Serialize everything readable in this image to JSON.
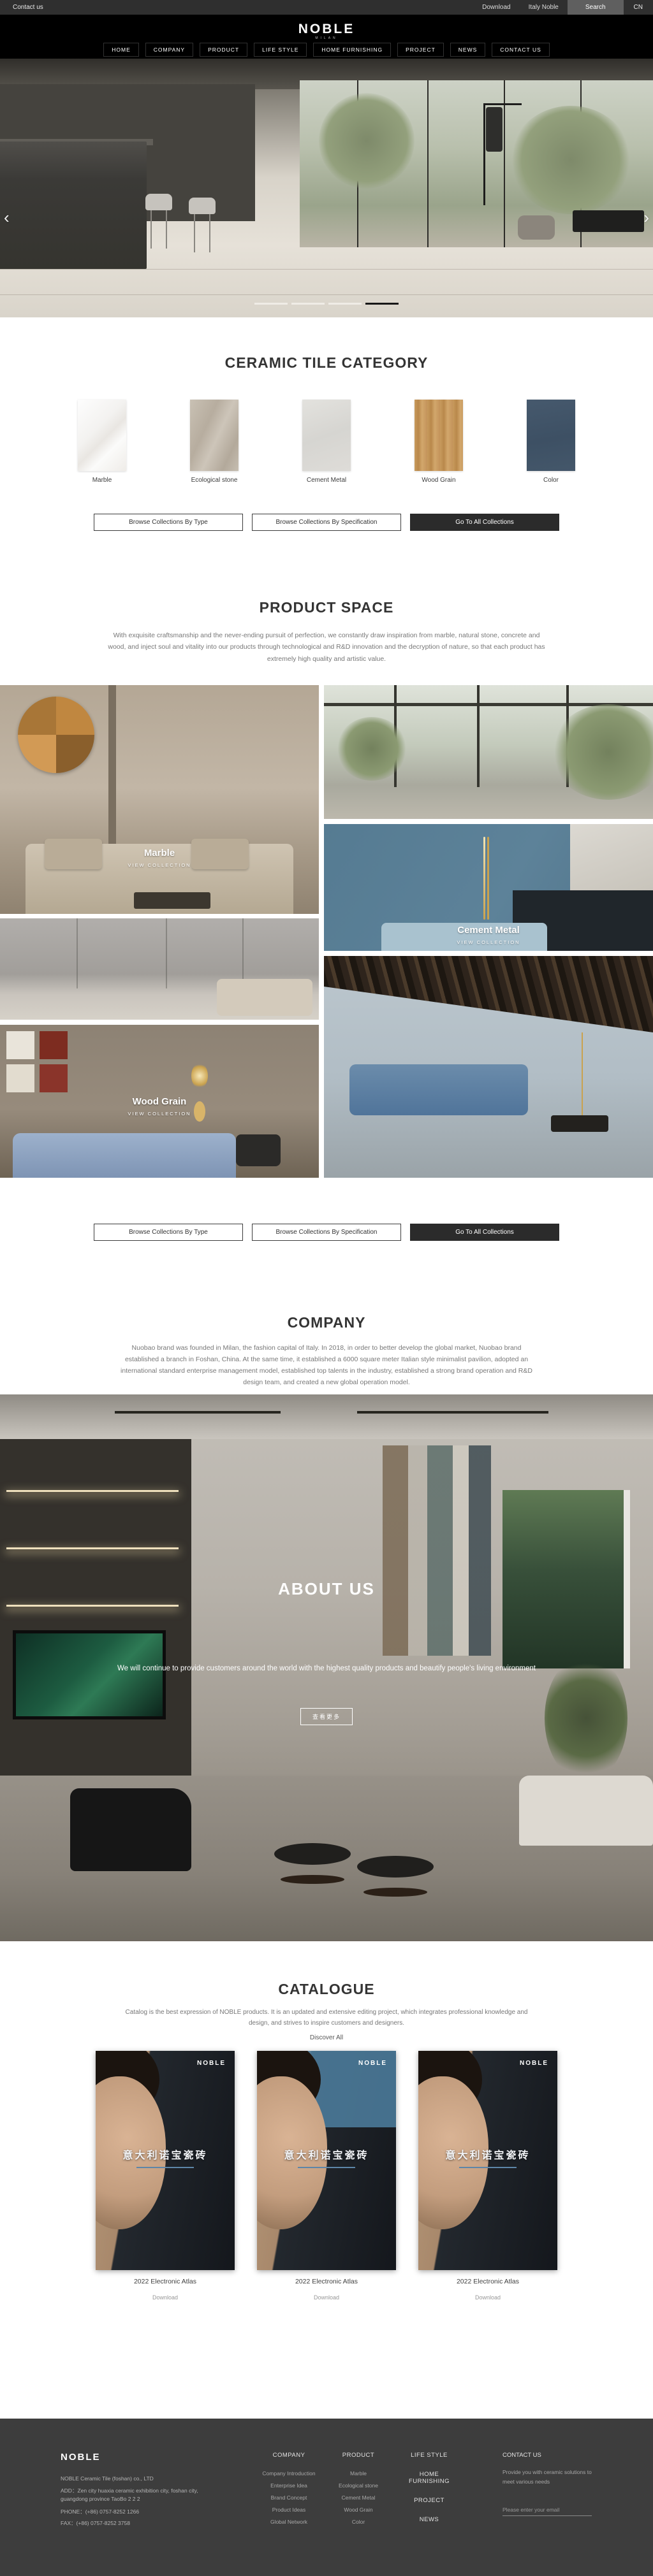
{
  "topbar": {
    "contact": "Contact us",
    "download": "Download",
    "italy_noble": "Italy Noble",
    "search": "Search",
    "lang": "CN"
  },
  "header": {
    "logo": "NOBLE",
    "logo_sub": "MILAN",
    "nav": [
      "HOME",
      "COMPANY",
      "PRODUCT",
      "LIFE STYLE",
      "HOME FURNISHING",
      "PROJECT",
      "NEWS",
      "CONTACT US"
    ]
  },
  "hero": {
    "prev": "‹",
    "next": "›",
    "slide_count": 4,
    "active_slide": 4
  },
  "category": {
    "title": "CERAMIC TILE CATEGORY",
    "tiles": [
      {
        "label": "Marble"
      },
      {
        "label": "Ecological stone"
      },
      {
        "label": "Cement Metal"
      },
      {
        "label": "Wood Grain"
      },
      {
        "label": "Color",
        "hex": "#41566b"
      }
    ]
  },
  "collection_buttons": {
    "by_type": "Browse Collections By Type",
    "by_spec": "Browse Collections By Specification",
    "all": "Go To All Collections"
  },
  "product_space": {
    "title": "PRODUCT SPACE",
    "description": "With exquisite craftsmanship and the never-ending pursuit of perfection, we constantly draw inspiration from marble, natural stone, concrete and wood, and inject soul and vitality into our products through technological and R&D innovation and the decryption of nature, so that each product has extremely high quality and artistic value.",
    "cards": [
      {
        "label": "Marble",
        "cta": "VIEW COLLECTION"
      },
      {
        "label": "Cement Metal",
        "cta": "VIEW COLLECTION"
      },
      {
        "label": "Wood Grain",
        "cta": "VIEW COLLECTION"
      }
    ],
    "accent_teal": "#5d8299"
  },
  "company": {
    "title": "COMPANY",
    "description": "Nuobao brand was founded in Milan, the fashion capital of Italy. In 2018, in order to better develop the global market, Nuobao brand established a branch in Foshan, China. At the same time, it established a 6000 square meter Italian style minimalist pavilion, adopted an international standard enterprise management model, established top talents in the industry, established a strong brand operation and R&D design team, and created a new global operation model."
  },
  "about": {
    "title": "ABOUT US",
    "tagline": "We will continue to provide customers around the world with the highest quality products and beautify people's living environment",
    "button": "查看更多"
  },
  "catalogue": {
    "title": "CATALOGUE",
    "description": "Catalog is the best expression of NOBLE products. It is an updated and extensive editing project, which integrates professional knowledge and design, and strives to inspire customers and designers.",
    "discover": "Discover All",
    "items": [
      {
        "title": "2022 Electronic Atlas",
        "download": "Download",
        "cover_brand": "NOBLE",
        "cover_title": "意大利诺宝瓷砖"
      },
      {
        "title": "2022 Electronic Atlas",
        "download": "Download",
        "cover_brand": "NOBLE",
        "cover_title": "意大利诺宝瓷砖"
      },
      {
        "title": "2022 Electronic Atlas",
        "download": "Download",
        "cover_brand": "NOBLE",
        "cover_title": "意大利诺宝瓷砖"
      }
    ]
  },
  "footer": {
    "brand": "NOBLE",
    "company_name": "NOBLE Ceramic Tile (foshan) co., LTD",
    "address": "ADD：Zen city huaxia ceramic exhibition city, foshan city, guangdong province TaoBo 2 2 2",
    "phone": "PHONE：(+86) 0757-8252 1266",
    "fax": "FAX：(+86) 0757-8252 3758",
    "columns": [
      {
        "title": "COMPANY",
        "links": [
          "Company Introduction",
          "Enterprise Idea",
          "Brand Concept",
          "Product Ideas",
          "Global Network"
        ]
      },
      {
        "title": "PRODUCT",
        "links": [
          "Marble",
          "Ecological stone",
          "Cement Metal",
          "Wood Grain",
          "Color"
        ]
      }
    ],
    "nav_headers": [
      "LIFE STYLE",
      "HOME FURNISHING",
      "PROJECT",
      "NEWS"
    ],
    "contact": {
      "title": "CONTACT US",
      "text": "Provide you with ceramic solutions to meet various needs",
      "email_placeholder": "Please enter your email"
    },
    "bg": "#3d3d3d"
  }
}
